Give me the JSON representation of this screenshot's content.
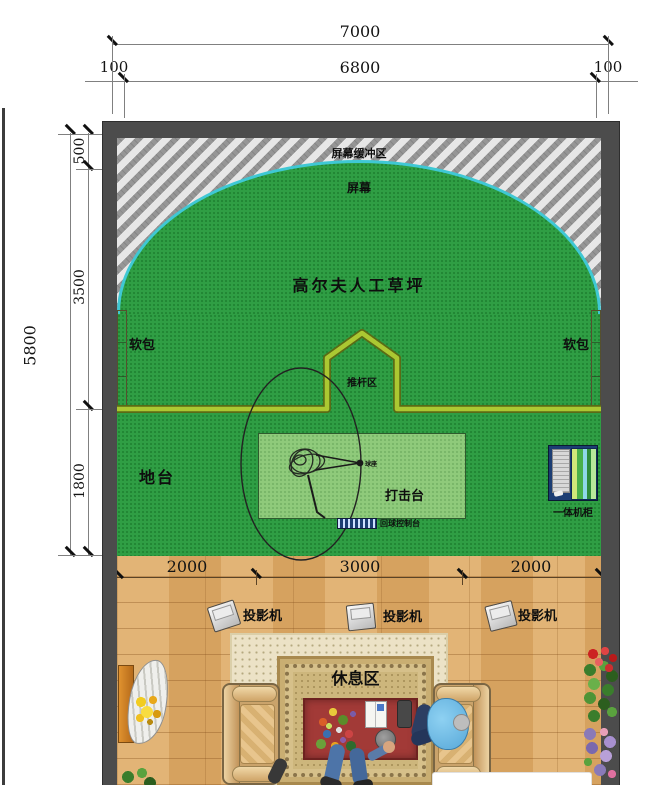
{
  "title": "高尔夫模拟器室内平面布置图",
  "areas": {
    "screen_buffer": "屏幕缓冲区",
    "screen": "屏幕",
    "turf": "高尔夫人工草坪",
    "soft_pad_left": "软包",
    "soft_pad_right": "软包",
    "putter_zone": "推杆区",
    "platform": "地台",
    "hitting_platform": "打击台",
    "tee": "球座",
    "ball_return_console": "回球控制台",
    "all_in_one_cabinet": "一体机柜",
    "rest_area": "休息区"
  },
  "projectors": [
    {
      "label": "投影机"
    },
    {
      "label": "投影机"
    },
    {
      "label": "投影机"
    }
  ],
  "dims": {
    "top": {
      "total": "7000",
      "margin_left": "100",
      "inner": "6800",
      "margin_right": "100"
    },
    "left": {
      "total": "5800",
      "segments": [
        "500",
        "3500",
        "1800"
      ]
    },
    "bottom": {
      "segments": [
        "2000",
        "3000",
        "2000"
      ]
    }
  },
  "colors": {
    "wall": "#4c4c4c",
    "turf": "#2f9e44",
    "turf-light": "#8fca7b",
    "screen-cyan": "#3fc8d4",
    "boundary-yellow": "#abc832",
    "wood": "#dcaa66",
    "carpet": "#ece2c6",
    "table-red": "#a23a37",
    "cabinet-blue": "#1c3d73",
    "sofa-tan": "#caa36b"
  }
}
